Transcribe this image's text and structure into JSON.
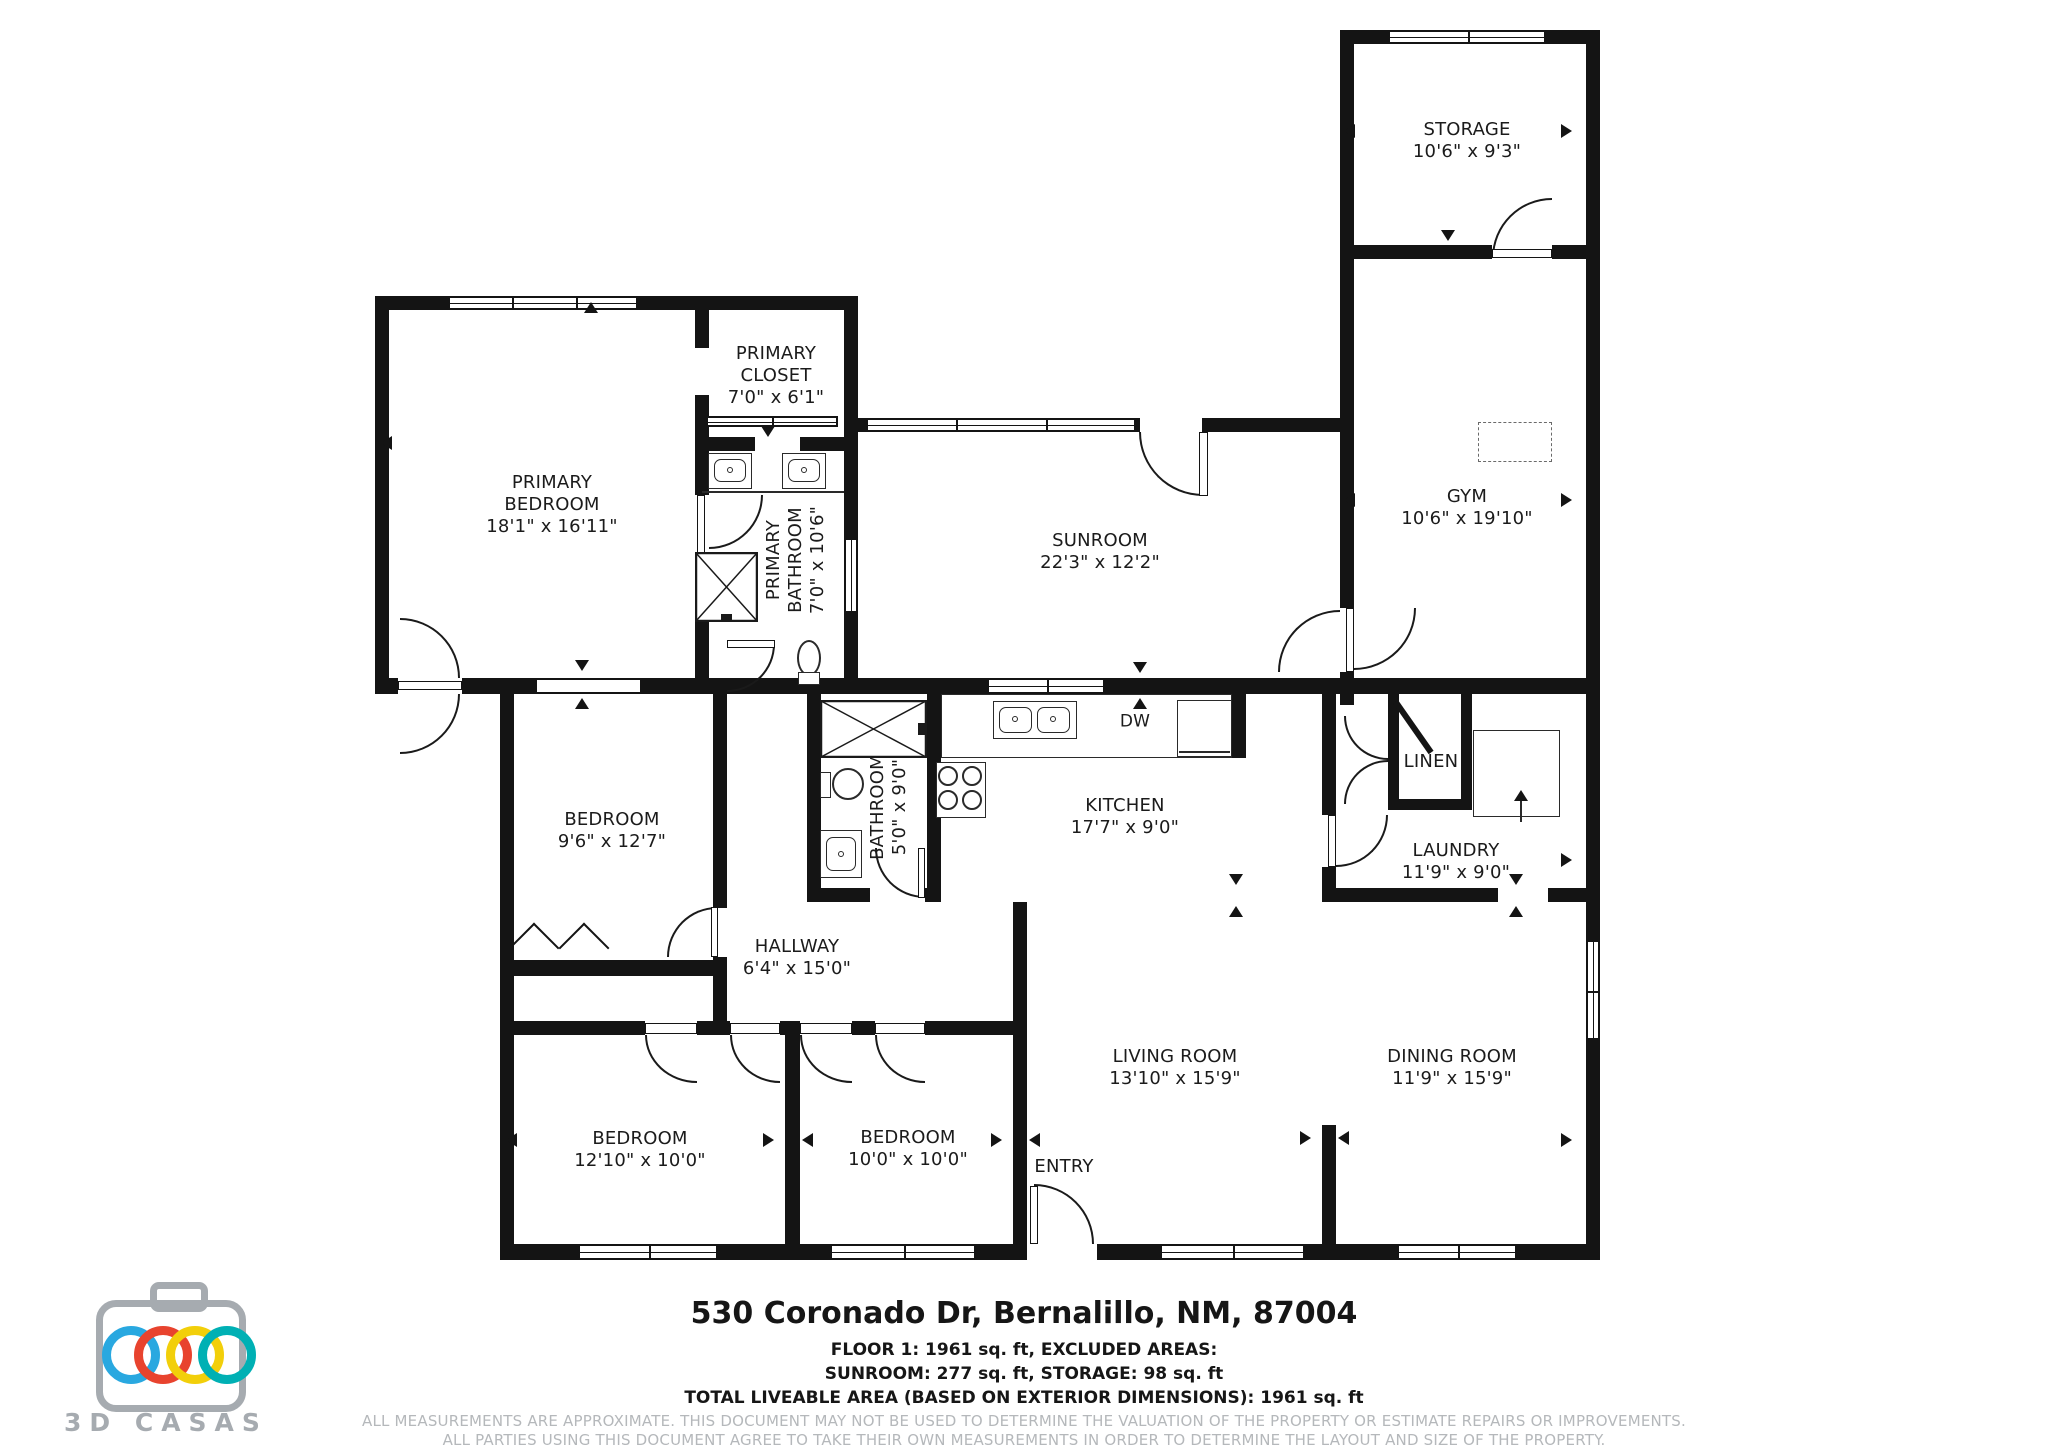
{
  "plan": {
    "rooms": [
      {
        "name": "STORAGE",
        "dims": "10'6\" x 9'3\""
      },
      {
        "name": "GYM",
        "dims": "10'6\" x 19'10\""
      },
      {
        "name": "PRIMARY CLOSET",
        "dims": "7'0\" x 6'1\""
      },
      {
        "name": "PRIMARY BEDROOM",
        "dims": "18'1\" x 16'11\""
      },
      {
        "name": "PRIMARY BATHROOM",
        "dims": "7'0\" x 10'6\""
      },
      {
        "name": "SUNROOM",
        "dims": "22'3\" x 12'2\""
      },
      {
        "name": "BEDROOM",
        "dims": "9'6\" x 12'7\""
      },
      {
        "name": "BATHROOM",
        "dims": "5'0\" x 9'0\""
      },
      {
        "name": "KITCHEN",
        "dims": "17'7\" x 9'0\""
      },
      {
        "name": "LINEN",
        "dims": ""
      },
      {
        "name": "LAUNDRY",
        "dims": "11'9\" x 9'0\""
      },
      {
        "name": "HALLWAY",
        "dims": "6'4\" x 15'0\""
      },
      {
        "name": "BEDROOM",
        "dims": "12'10\" x 10'0\""
      },
      {
        "name": "BEDROOM",
        "dims": "10'0\" x 10'0\""
      },
      {
        "name": "ENTRY",
        "dims": ""
      },
      {
        "name": "LIVING ROOM",
        "dims": "13'10\" x 15'9\""
      },
      {
        "name": "DINING ROOM",
        "dims": "11'9\" x 15'9\""
      }
    ],
    "appliance_labels": {
      "dishwasher": "DW"
    }
  },
  "footer": {
    "address": "530 Coronado Dr, Bernalillo, NM, 87004",
    "floor_line": "FLOOR 1: 1961 sq. ft, EXCLUDED AREAS:",
    "excluded_line": "SUNROOM: 277 sq. ft, STORAGE: 98 sq. ft",
    "total_line": "TOTAL LIVEABLE AREA (BASED ON EXTERIOR DIMENSIONS): 1961 sq. ft",
    "disclaimer_line1": "ALL MEASUREMENTS ARE APPROXIMATE. THIS DOCUMENT MAY NOT BE USED TO DETERMINE THE VALUATION OF THE PROPERTY OR ESTIMATE REPAIRS OR IMPROVEMENTS.",
    "disclaimer_line2": "ALL PARTIES USING THIS DOCUMENT AGREE TO TAKE THEIR OWN MEASUREMENTS IN ORDER TO DETERMINE THE LAYOUT AND SIZE OF THE PROPERTY."
  },
  "logo": {
    "brand": "3D CASAS",
    "ring_colors": [
      "#29a8e0",
      "#e8432e",
      "#f2cf0a",
      "#00b0b4"
    ],
    "body_color": "#a6abb0",
    "wall_color": "#141414"
  }
}
